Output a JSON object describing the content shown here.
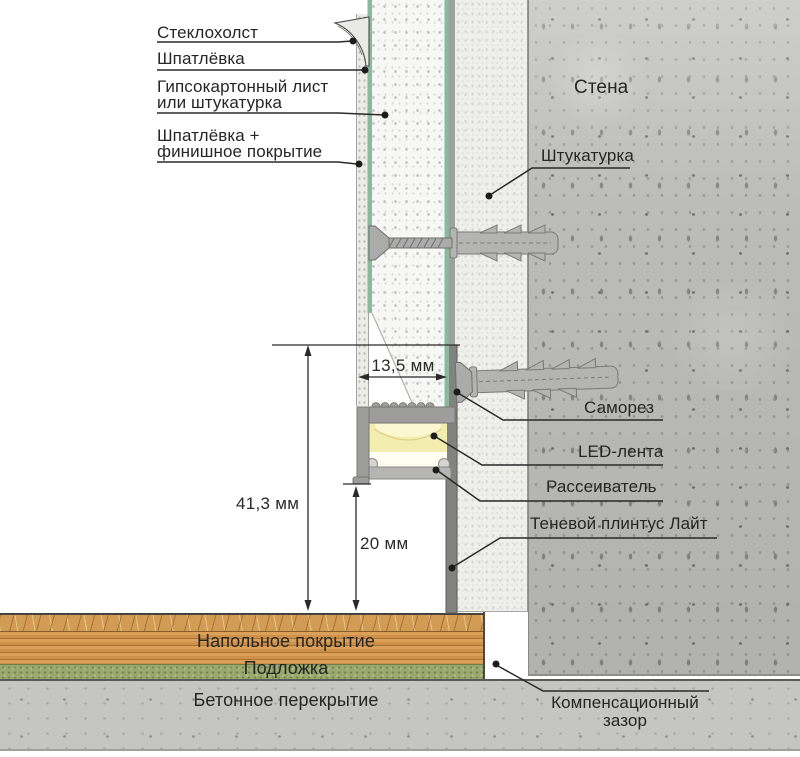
{
  "annotations": {
    "glass_fleece": "Стеклохолст",
    "putty": "Шпатлёвка",
    "drywall": "Гипсокартонный лист\nили штукатурка",
    "finish_coat": "Шпатлёвка +\nфинишное покрытие",
    "wall": "Стена",
    "plaster": "Штукатурка",
    "screw": "Саморез",
    "led_strip": "LED-лента",
    "diffuser": "Рассеиватель",
    "shadow_plinth": "Теневой плинтус Лайт",
    "floor_covering": "Напольное покрытие",
    "underlay": "Подложка",
    "concrete_slab": "Бетонное перекрытие",
    "compensation_gap": "Компенсационный\nзазор"
  },
  "dimensions": {
    "channel_width": "13,5 мм",
    "total_height": "41,3 мм",
    "bottom_clearance": "20 мм"
  },
  "colors": {
    "drywall_face_green": "#8aba9e",
    "led_glow_yellow": "#f3eeb0",
    "aluminum_profile": "#9d9d9b",
    "wood_floor": "#d29c55",
    "underlay_green": "#9aa96e",
    "concrete": "#bcbcba",
    "line_ink": "#2a2a2a"
  }
}
